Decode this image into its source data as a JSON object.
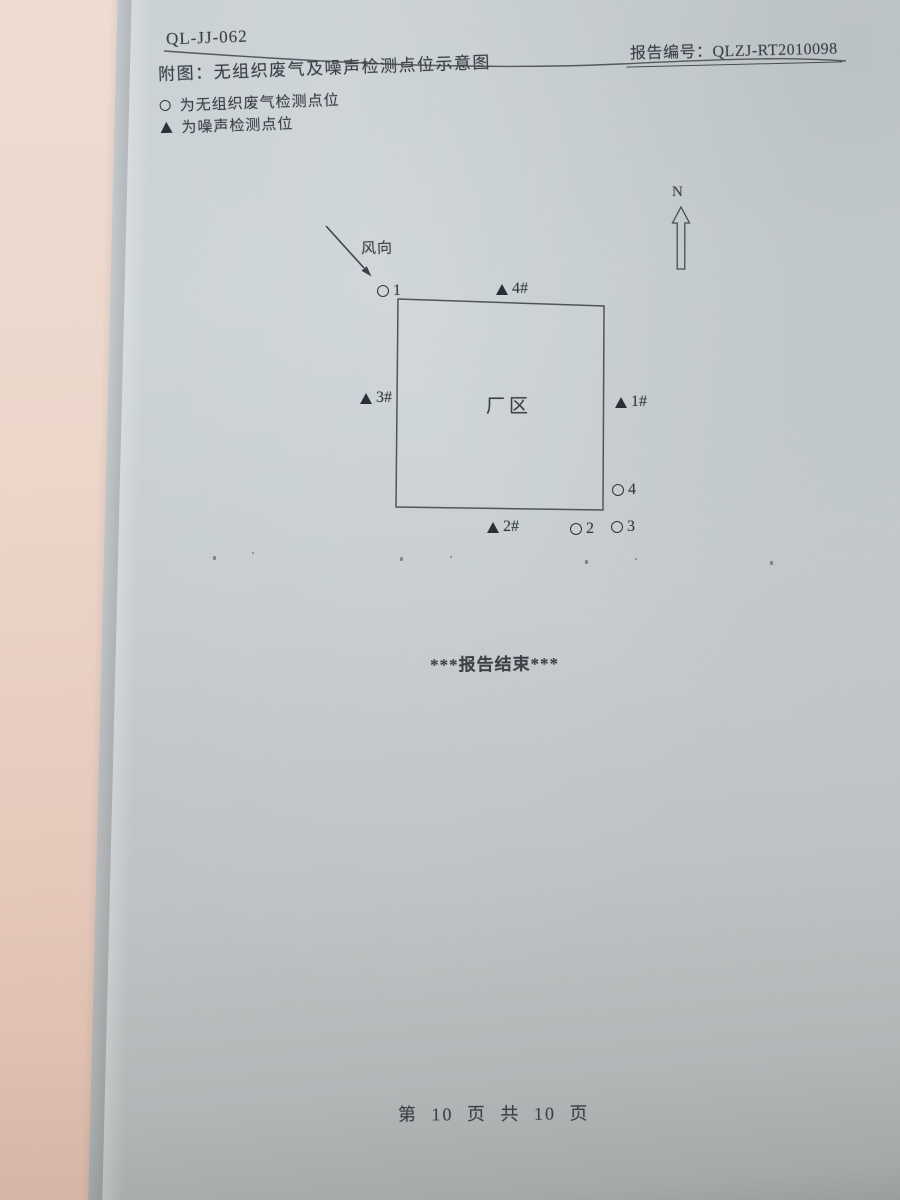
{
  "header": {
    "doc_code": "QL-JJ-062",
    "report_no": "报告编号：QLZJ-RT2010098",
    "figure_title": "附图：无组织废气及噪声检测点位示意图"
  },
  "legend": {
    "gas_label": "为无组织废气检测点位",
    "noise_label": "为噪声检测点位"
  },
  "diagram": {
    "north_label": "N",
    "wind_label": "风向",
    "factory_label": "厂区",
    "points": {
      "gas1": "1",
      "gas2": "2",
      "gas3": "3",
      "gas4": "4",
      "noise1": "1#",
      "noise2": "2#",
      "noise3": "3#",
      "noise4": "4#"
    }
  },
  "footer": {
    "end_text": "***报告结束***",
    "page_text": "第 10 页 共 10 页"
  },
  "colors": {
    "paper": "#c8cfd3",
    "side_page": "#ecd9d0",
    "ink": "#3b4046"
  }
}
